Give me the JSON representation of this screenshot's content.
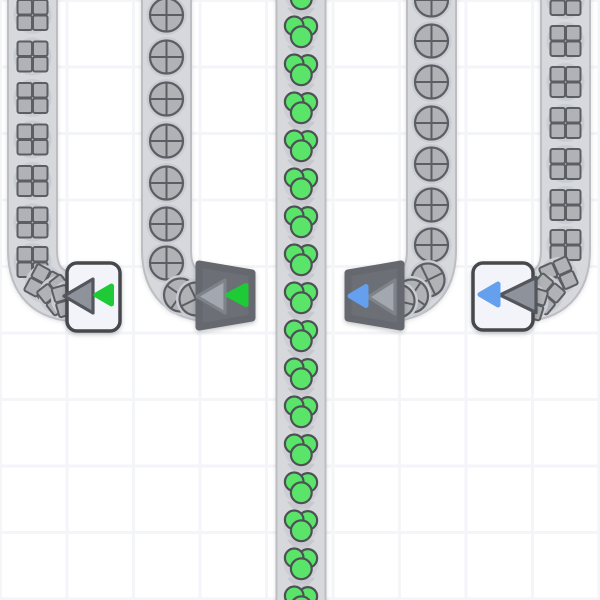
{
  "scene": {
    "width": 600,
    "height": 600,
    "background": "#ffffff",
    "grid_cell": 66.5,
    "grid_line_color": "#f4f5f8"
  },
  "colors": {
    "belt_fill": "#d7d8dc",
    "belt_edge": "#bcbec4",
    "item_gray": "#b1b2b5",
    "item_outline": "#5b5e63",
    "item_backdrop": "#c9ccd2",
    "berry_green": "#5ae56a",
    "berry_outline": "#4d5155",
    "berry_backdrop": "#cdced4",
    "arrow_gray": "#c7c8cd",
    "box_fill": "#f2f4f9",
    "box_border": "#46484d",
    "box_triangle_fill": "#8e939b",
    "box_triangle_edge": "#53565c",
    "funnel_fill": "#6c6f75",
    "funnel_edge": "#65686e",
    "funnel_triangle_fill": "#a3a8b0",
    "funnel_triangle_edge": "#7e838a",
    "accent_green": "#1fca37",
    "accent_blue": "#64a0ee"
  },
  "belts": [
    {
      "id": "belt-1",
      "item_type": "quad-square",
      "path": "M 32.5 -20 V 250 Q 32.5 297 79.5 297 L 94 297",
      "items": [
        [
          32.5,
          15,
          0
        ],
        [
          32.5,
          56.5,
          0
        ],
        [
          32.5,
          98,
          0
        ],
        [
          32.5,
          139.5,
          0
        ],
        [
          32.5,
          181,
          0
        ],
        [
          32.5,
          222.5,
          0
        ],
        [
          32.5,
          262,
          0
        ],
        [
          44,
          284,
          28
        ],
        [
          57.5,
          295,
          52
        ],
        [
          70,
          299,
          74
        ]
      ]
    },
    {
      "id": "belt-2",
      "item_type": "quad-circle",
      "path": "M 166.5 -20 V 250 Q 166.5 297 213.5 297 L 227 297",
      "items": [
        [
          166.5,
          15,
          0
        ],
        [
          166.5,
          57,
          0
        ],
        [
          166.5,
          99,
          0
        ],
        [
          166.5,
          141,
          0
        ],
        [
          166.5,
          183,
          0
        ],
        [
          166.5,
          224,
          0
        ],
        [
          166.5,
          263,
          0
        ],
        [
          180.5,
          295,
          35
        ],
        [
          196,
          299,
          64
        ]
      ]
    },
    {
      "id": "belt-3",
      "item_type": "berry-cluster",
      "path": "M 301 -20 V 620",
      "arrow_x": 301,
      "arrow_ys": [
        14,
        52,
        90,
        128,
        166,
        204,
        242,
        280,
        318,
        356,
        394,
        432,
        470,
        508,
        546,
        584
      ],
      "items": [
        [
          301,
          -7,
          0
        ],
        [
          301,
          31,
          0
        ],
        [
          301,
          69,
          0
        ],
        [
          301,
          107,
          0
        ],
        [
          301,
          145,
          0
        ],
        [
          301,
          183,
          0
        ],
        [
          301,
          221,
          0
        ],
        [
          301,
          259,
          0
        ],
        [
          301,
          297,
          0
        ],
        [
          301,
          335,
          0
        ],
        [
          301,
          373,
          0
        ],
        [
          301,
          411,
          0
        ],
        [
          301,
          449,
          0
        ],
        [
          301,
          487,
          0
        ],
        [
          301,
          525,
          0
        ],
        [
          301,
          563,
          0
        ],
        [
          301,
          601,
          0
        ]
      ]
    },
    {
      "id": "belt-4",
      "item_type": "quad-circle",
      "path": "M 431.5 -20 V 250 Q 431.5 297 384.5 297 L 372 297",
      "items": [
        [
          431.5,
          0,
          0
        ],
        [
          431.5,
          41,
          0
        ],
        [
          431.5,
          82,
          0
        ],
        [
          431.5,
          123,
          0
        ],
        [
          431.5,
          164,
          0
        ],
        [
          431.5,
          205,
          0
        ],
        [
          431.5,
          245,
          0
        ],
        [
          428,
          280,
          -26
        ],
        [
          411.5,
          296,
          -56
        ],
        [
          398,
          301,
          -77
        ]
      ]
    },
    {
      "id": "belt-5",
      "item_type": "quad-square",
      "path": "M 565.5 -20 V 250 Q 565.5 297 518.5 297 L 502 297",
      "items": [
        [
          565.5,
          0,
          0
        ],
        [
          565.5,
          41,
          0
        ],
        [
          565.5,
          82,
          0
        ],
        [
          565.5,
          123,
          0
        ],
        [
          565.5,
          164,
          0
        ],
        [
          565.5,
          205,
          0
        ],
        [
          565.5,
          245,
          0
        ],
        [
          558.5,
          276,
          -24
        ],
        [
          544.5,
          294,
          -50
        ],
        [
          529.5,
          302,
          -73
        ]
      ]
    }
  ],
  "devices": [
    {
      "id": "filter-1",
      "style": "box",
      "accent_name": "green",
      "rect": [
        67,
        263,
        53,
        68
      ],
      "big_triangle": [
        [
          64,
          296
        ],
        [
          93,
          279
        ],
        [
          93,
          313
        ]
      ],
      "small_triangle": [
        [
          96,
          295
        ],
        [
          111.5,
          286
        ],
        [
          111.5,
          304
        ]
      ]
    },
    {
      "id": "filter-2",
      "style": "funnel",
      "accent_name": "green",
      "body": [
        [
          199,
          264
        ],
        [
          252,
          273
        ],
        [
          252,
          318
        ],
        [
          199,
          327
        ]
      ],
      "big_triangle": [
        [
          197,
          296.5
        ],
        [
          225,
          280
        ],
        [
          225,
          313
        ]
      ],
      "small_triangle": [
        [
          228,
          295
        ],
        [
          246,
          285.5
        ],
        [
          246,
          304.5
        ]
      ]
    },
    {
      "id": "filter-3",
      "style": "funnel",
      "accent_name": "blue",
      "body": [
        [
          348,
          273
        ],
        [
          401,
          264
        ],
        [
          401,
          327
        ],
        [
          348,
          318
        ]
      ],
      "big_triangle": [
        [
          368,
          297
        ],
        [
          395,
          280
        ],
        [
          395,
          314
        ]
      ],
      "small_triangle": [
        [
          350,
          296
        ],
        [
          366,
          286.5
        ],
        [
          366,
          305.5
        ]
      ]
    },
    {
      "id": "filter-4",
      "style": "box",
      "accent_name": "blue",
      "rect": [
        473,
        263,
        60,
        67
      ],
      "big_triangle": [
        [
          500,
          295
        ],
        [
          536,
          277.5
        ],
        [
          536,
          312.5
        ]
      ],
      "small_triangle": [
        [
          480,
          294.5
        ],
        [
          498,
          284
        ],
        [
          498,
          305
        ]
      ]
    }
  ]
}
